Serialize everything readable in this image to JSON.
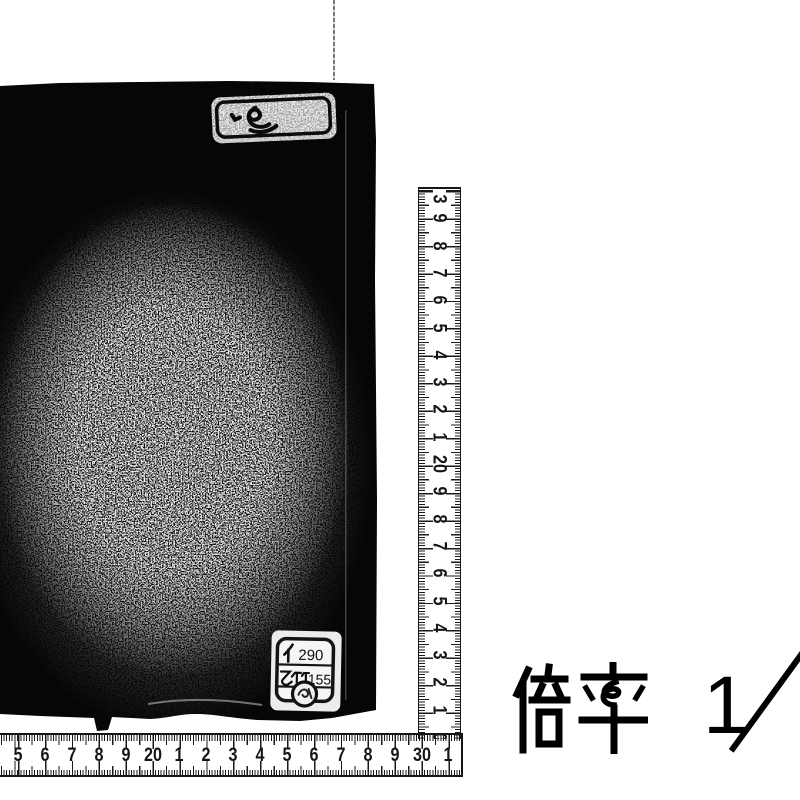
{
  "page": {
    "background_color": "#ffffff",
    "content": "Archival photograph of a dark book cover with centimetre rulers and magnification note"
  },
  "book": {
    "cover_color": "#060606",
    "title_slip": {
      "inscription": "handwritten cursive kanji (illegible)"
    },
    "call_number_label": {
      "row1_kana": "イ",
      "row1_number": "290",
      "row1_text": "イ 290",
      "row2_kanji": "乙竹",
      "row2_number": "155",
      "row2_text": "乙竹 155",
      "stamp": "small circular seal"
    }
  },
  "vertical_ruler": {
    "unit": "cm",
    "labels_top_to_bottom": [
      "3",
      "9",
      "8",
      "7",
      "6",
      "5",
      "4",
      "3",
      "2",
      "1",
      "20",
      "9",
      "8",
      "7",
      "6",
      "5",
      "4",
      "3",
      "2",
      "1",
      "0"
    ]
  },
  "horizontal_ruler": {
    "unit": "cm",
    "labels_left_to_right": [
      "5",
      "6",
      "7",
      "8",
      "9",
      "20",
      "1",
      "2",
      "3",
      "4",
      "5",
      "6",
      "7",
      "8",
      "9",
      "30",
      "1"
    ]
  },
  "magnification": {
    "label": "倍率",
    "ratio_numerator": "1",
    "ratio_slash": "／",
    "full_text": "倍率 1／"
  }
}
